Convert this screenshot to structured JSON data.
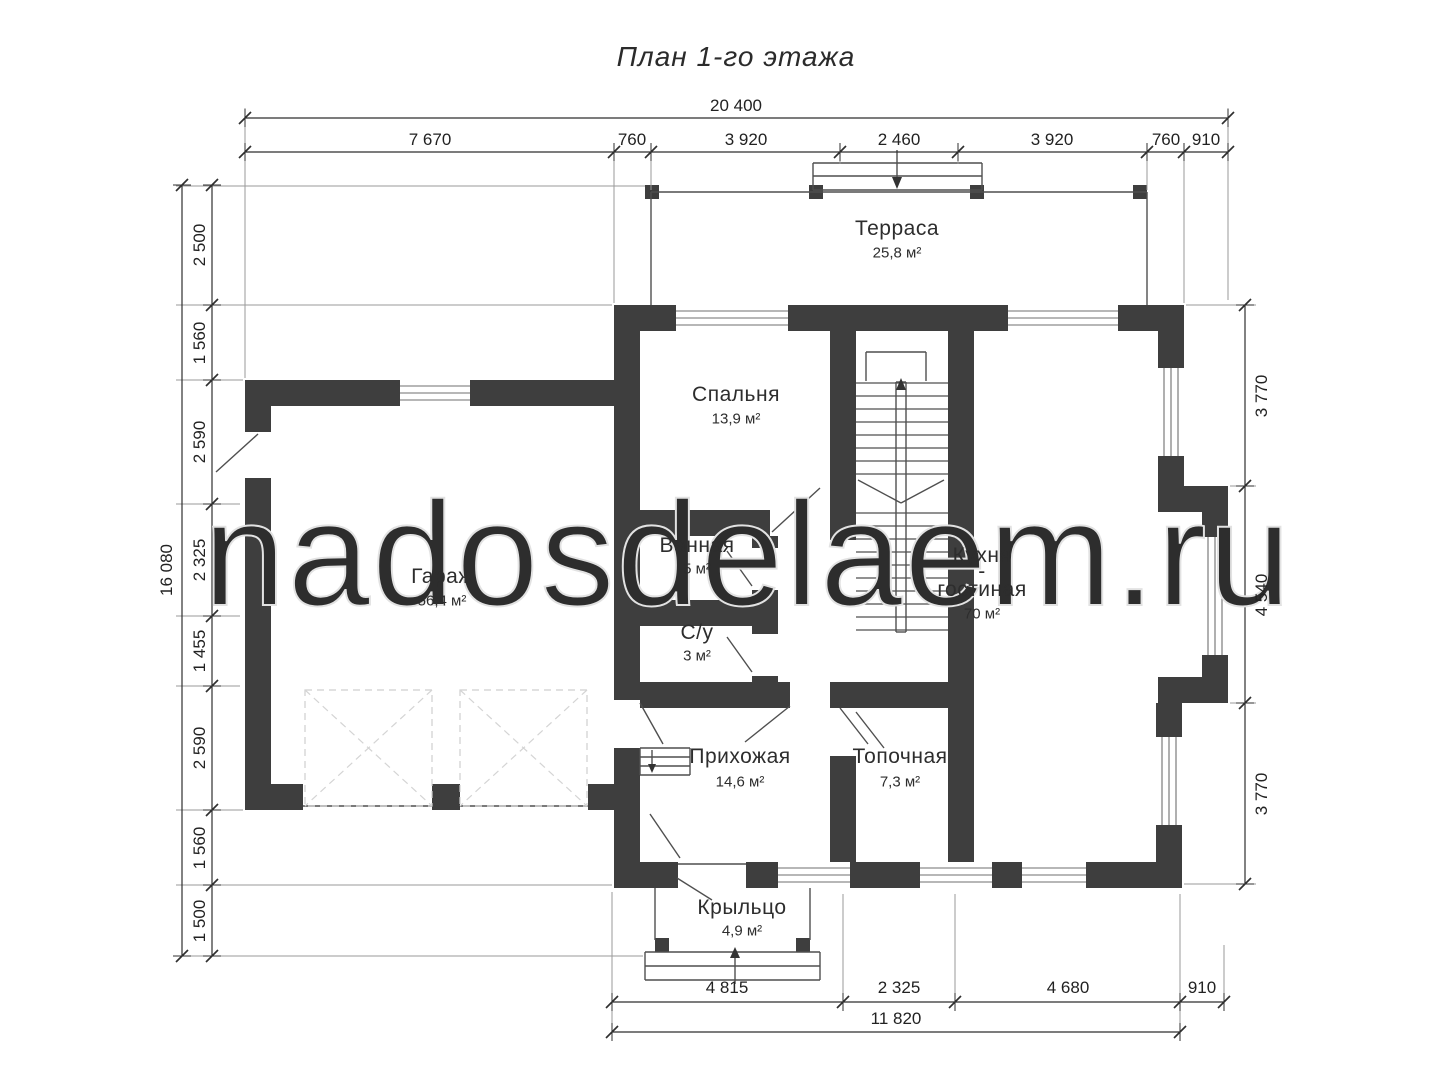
{
  "title": "План 1-го этажа",
  "watermark": "nadosdelaem.ru",
  "rooms": [
    {
      "name": "Терраса",
      "area": "25,8 м²"
    },
    {
      "name": "Спальня",
      "area": "13,9 м²"
    },
    {
      "name": "Гараж",
      "area": "56,4 м²"
    },
    {
      "name": "Ванная",
      "area": "5 м²"
    },
    {
      "name": "С/у",
      "area": "3 м²"
    },
    {
      "name": "Кухня",
      "hyphen": "-",
      "name2": "гостиная",
      "area": "70 м²"
    },
    {
      "name": "Прихожая",
      "area": "14,6 м²"
    },
    {
      "name": "Топочная",
      "area": "7,3 м²"
    },
    {
      "name": "Крыльцо",
      "area": "4,9 м²"
    }
  ],
  "dimensions": {
    "top_total": "20 400",
    "top_segments": [
      "7 670",
      "760",
      "3 920",
      "2 460",
      "3 920",
      "760",
      "910"
    ],
    "left_total": "16 080",
    "left_segments": [
      "2 500",
      "1 560",
      "2 590",
      "2 325",
      "1 455",
      "2 590",
      "1 560",
      "1 500"
    ],
    "right_segments": [
      "3 770",
      "4 540",
      "3 770"
    ],
    "bottom_segments": [
      "4 815",
      "2 325",
      "4 680",
      "910"
    ],
    "bottom_total": "11 820"
  }
}
